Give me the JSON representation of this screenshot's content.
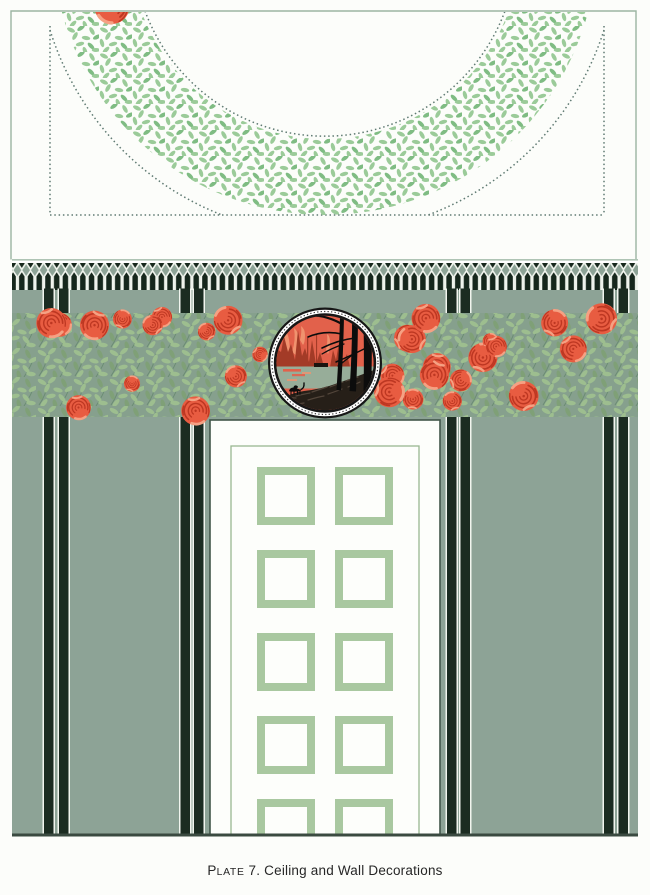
{
  "caption": {
    "lead": "P",
    "small_caps": "LATE",
    "rest": " 7. Ceiling and Wall Decorations",
    "full_text": "Plate 7. Ceiling and Wall Decorations"
  },
  "decor": {
    "wreath_roses": 19,
    "frieze_roses": 30,
    "door_panel_rows": 5,
    "door_panel_cols": 2
  },
  "palette": {
    "pageBg": "#fcfdfa",
    "frameLine": "#9bb5a2",
    "dottedLine": "#5f7a72",
    "sage": "#8da396",
    "picketDark": "#16271c",
    "barDark": "#1b2c21",
    "lineLight": "#f1f5ee",
    "friezeBg": "#86a08d",
    "leafCeil": "#9bcb99",
    "leafCeilDark": "#7fbc83",
    "leafFrieze": "#9dbe8f",
    "leafFriezeDark": "#7fa077",
    "stemFrieze": "#6b8c73",
    "rose": "#e85c41",
    "roseDark": "#bd3722",
    "roseLight": "#f5a183",
    "doorWhite": "#fdfefb",
    "doorEdge": "#42564a",
    "doorLine": "#99b791",
    "panelGreen": "#a9c8a0",
    "floorLine": "#3a4a40",
    "ringDark": "#161616",
    "beadDot": "#3a3a3a",
    "medSky": "#e2614b",
    "medSkyLight": "#f0926e",
    "medSil": "#a33b27",
    "medWater": "#97ad99",
    "medGround": "#261f18",
    "medGroundLight": "#52453a",
    "treeBlack": "#0c0c0c",
    "captionColor": "#262626"
  }
}
